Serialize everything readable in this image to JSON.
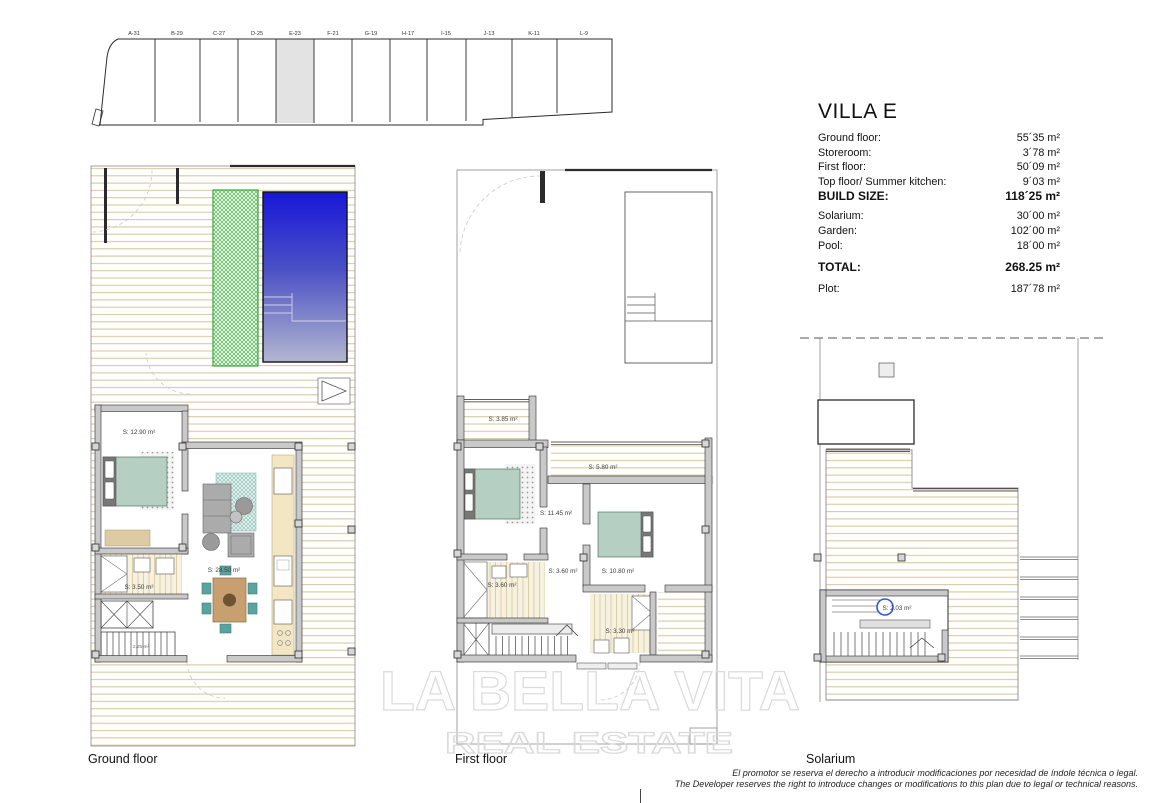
{
  "site_plan": {
    "plots": [
      "A-31",
      "B-29",
      "C-27",
      "D-25",
      "E-23",
      "F-21",
      "G-19",
      "H-17",
      "I-15",
      "J-13",
      "K-11",
      "L-9"
    ],
    "highlighted_plot": "E-23"
  },
  "specs": {
    "title": "VILLA E",
    "rows": [
      {
        "label": "Ground floor:",
        "value": "55´35 m²"
      },
      {
        "label": "Storeroom:",
        "value": "3´78 m²"
      },
      {
        "label": "First floor:",
        "value": "50´09 m²"
      },
      {
        "label": "Top floor/ Summer kitchen:",
        "value": "9´03 m²"
      },
      {
        "label": "BUILD SIZE:",
        "value": "118´25 m²"
      },
      {
        "label": "Solarium:",
        "value": "30´00 m²"
      },
      {
        "label": "Garden:",
        "value": "102´00 m²"
      },
      {
        "label": "Pool:",
        "value": "18´00 m²"
      },
      {
        "label": "TOTAL:",
        "value": "268.25 m²"
      },
      {
        "label": "Plot:",
        "value": "187´78 m²"
      }
    ]
  },
  "floors": {
    "ground": {
      "name": "Ground floor",
      "labels": {
        "bedroom": "S: 12.90 m²",
        "living": "S: 28.50 m²",
        "bathroom": "S: 3.50 m²",
        "stairs": "2.25 m²"
      }
    },
    "first": {
      "name": "First floor",
      "labels": {
        "terrace_top": "S: 3.85 m²",
        "terrace_right": "S: 5.80 m²",
        "bedroom_left": "S: 11.45 m²",
        "hall": "S: 3.60 m²",
        "bedroom_right": "S: 10.80 m²",
        "bathroom_left": "S: 3.60 m²",
        "bathroom_right": "S: 3.30 m²"
      }
    },
    "solarium": {
      "name": "Solarium",
      "labels": {
        "stair_room": "S: 2.03 m²"
      }
    }
  },
  "watermark": {
    "line1": "LA BELLA VITA",
    "line2": "REAL ESTATE"
  },
  "disclaimer": {
    "line1": "El promotor se reserva el derecho a introducir modificaciones por necesidad de índole técnica o legal.",
    "line2": "The Developer reserves the right to introduce changes or modifications to this plan due to legal or technical reasons."
  },
  "colors": {
    "pool_blue": "#1717d8",
    "pool_fade": "#b3b6cf",
    "garden_hatch_green": "#58b558",
    "deck_line_tan": "#d9c9a2",
    "bed_teal": "#b5cfc2",
    "chair_teal": "#5ba3a0",
    "plot_highlight_gray": "#e3e3e3",
    "watermark_gray": "#dadada",
    "stair_circle_blue": "#3355dd"
  }
}
